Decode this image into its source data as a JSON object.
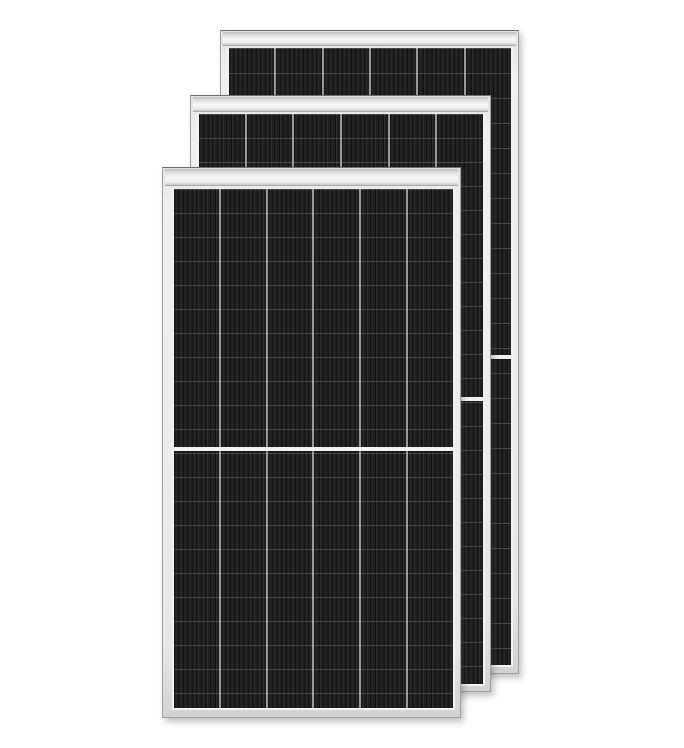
{
  "meta": {
    "alt": "Three stacked black monocrystalline half-cut solar PV modules with silver frames on a white background",
    "background_color": "#ffffff"
  },
  "colors": {
    "bg": "#ffffff",
    "frame": "#ececec",
    "frame_edge": "#9f9f9f",
    "frame_top_edge": "#6f6f6f",
    "topbar_light": "#f7f7f7",
    "topbar_shade": "#c7c7c7",
    "inner_margin": "#f3f3f3",
    "cell_divider": "#9a9a9a",
    "stripe_dark": "#141414",
    "stripe_light": "#2e2e2e",
    "stripe_mid": "#1f1f1f",
    "row_line": "rgba(214,214,214,0.22)",
    "split_line": "#f2f2f2",
    "shadow": "rgba(60,60,60,0.30)"
  },
  "panels": [
    {
      "id": "back",
      "x": 220,
      "y": 30,
      "width": 299,
      "height": 644,
      "bar_height": 13,
      "pad_top": 17,
      "pad_left": 8,
      "pad_right": 7,
      "pad_bottom": 8,
      "columns": 6,
      "row_pitch": 25,
      "has_split": true,
      "z": 1
    },
    {
      "id": "middle",
      "x": 190,
      "y": 95,
      "width": 301,
      "height": 597,
      "bar_height": 14,
      "pad_top": 18,
      "pad_left": 8,
      "pad_right": 7,
      "pad_bottom": 7,
      "columns": 6,
      "row_pitch": 24,
      "has_split": true,
      "z": 2
    },
    {
      "id": "front",
      "x": 162,
      "y": 167,
      "width": 299,
      "height": 551,
      "bar_height": 16,
      "pad_top": 21,
      "pad_left": 11,
      "pad_right": 7,
      "pad_bottom": 9,
      "columns": 6,
      "row_pitch": 24,
      "has_split": true,
      "z": 3
    }
  ]
}
